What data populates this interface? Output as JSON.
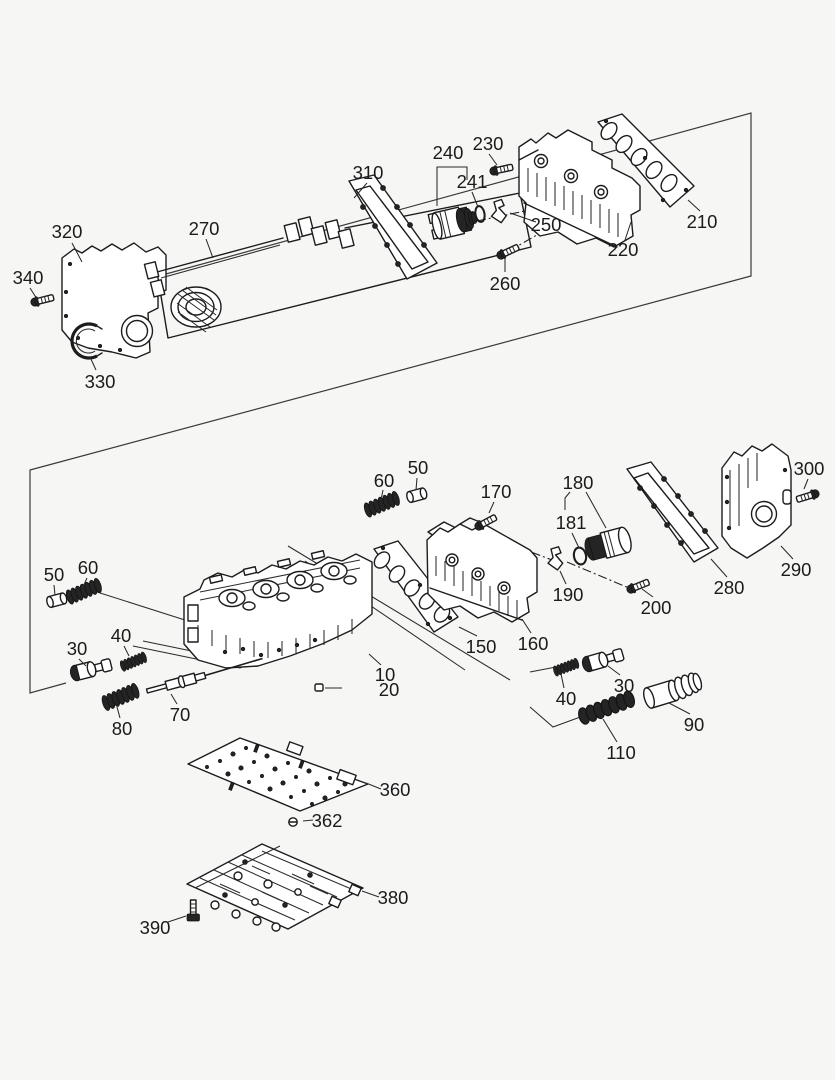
{
  "diagram": {
    "figure_type": "exploded-parts-diagram",
    "background": "#f6f6f5",
    "line_color": "#1c1c1c",
    "label_color": "#1b1b1b",
    "label_font_px": 18.5,
    "part_labels": [
      {
        "id": "320",
        "t": "320",
        "x": 67,
        "y": 231
      },
      {
        "id": "340",
        "t": "340",
        "x": 28,
        "y": 277
      },
      {
        "id": "330",
        "t": "330",
        "x": 100,
        "y": 381
      },
      {
        "id": "270",
        "t": "270",
        "x": 204,
        "y": 228
      },
      {
        "id": "310",
        "t": "310",
        "x": 368,
        "y": 172
      },
      {
        "id": "240",
        "t": "240",
        "x": 448,
        "y": 152
      },
      {
        "id": "241",
        "t": "241",
        "x": 472,
        "y": 181
      },
      {
        "id": "230",
        "t": "230",
        "x": 488,
        "y": 143
      },
      {
        "id": "250",
        "t": "250",
        "x": 546,
        "y": 224
      },
      {
        "id": "260",
        "t": "260",
        "x": 505,
        "y": 283
      },
      {
        "id": "220",
        "t": "220",
        "x": 623,
        "y": 249
      },
      {
        "id": "210",
        "t": "210",
        "x": 702,
        "y": 221
      },
      {
        "id": "60-top",
        "t": "60",
        "x": 384,
        "y": 480
      },
      {
        "id": "50-top",
        "t": "50",
        "x": 418,
        "y": 467
      },
      {
        "id": "170",
        "t": "170",
        "x": 496,
        "y": 491
      },
      {
        "id": "180",
        "t": "180",
        "x": 578,
        "y": 482
      },
      {
        "id": "181",
        "t": "181",
        "x": 571,
        "y": 522
      },
      {
        "id": "300",
        "t": "300",
        "x": 809,
        "y": 468
      },
      {
        "id": "290",
        "t": "290",
        "x": 796,
        "y": 569
      },
      {
        "id": "280",
        "t": "280",
        "x": 729,
        "y": 587
      },
      {
        "id": "200",
        "t": "200",
        "x": 656,
        "y": 607
      },
      {
        "id": "190",
        "t": "190",
        "x": 568,
        "y": 594
      },
      {
        "id": "160",
        "t": "160",
        "x": 533,
        "y": 643
      },
      {
        "id": "150",
        "t": "150",
        "x": 481,
        "y": 646
      },
      {
        "id": "10",
        "t": "10",
        "x": 385,
        "y": 674
      },
      {
        "id": "20",
        "t": "20",
        "x": 389,
        "y": 689
      },
      {
        "id": "50-left",
        "t": "50",
        "x": 54,
        "y": 574
      },
      {
        "id": "60-left",
        "t": "60",
        "x": 88,
        "y": 567
      },
      {
        "id": "30-left",
        "t": "30",
        "x": 77,
        "y": 648
      },
      {
        "id": "40-left",
        "t": "40",
        "x": 121,
        "y": 635
      },
      {
        "id": "80",
        "t": "80",
        "x": 122,
        "y": 728
      },
      {
        "id": "70",
        "t": "70",
        "x": 180,
        "y": 714
      },
      {
        "id": "40-right",
        "t": "40",
        "x": 566,
        "y": 698
      },
      {
        "id": "30-right",
        "t": "30",
        "x": 624,
        "y": 685
      },
      {
        "id": "110",
        "t": "110",
        "x": 621,
        "y": 752
      },
      {
        "id": "90",
        "t": "90",
        "x": 694,
        "y": 724
      },
      {
        "id": "360",
        "t": "360",
        "x": 395,
        "y": 789
      },
      {
        "id": "362",
        "t": "362",
        "x": 327,
        "y": 820
      },
      {
        "id": "380",
        "t": "380",
        "x": 393,
        "y": 897
      },
      {
        "id": "390",
        "t": "390",
        "x": 155,
        "y": 927
      }
    ]
  }
}
